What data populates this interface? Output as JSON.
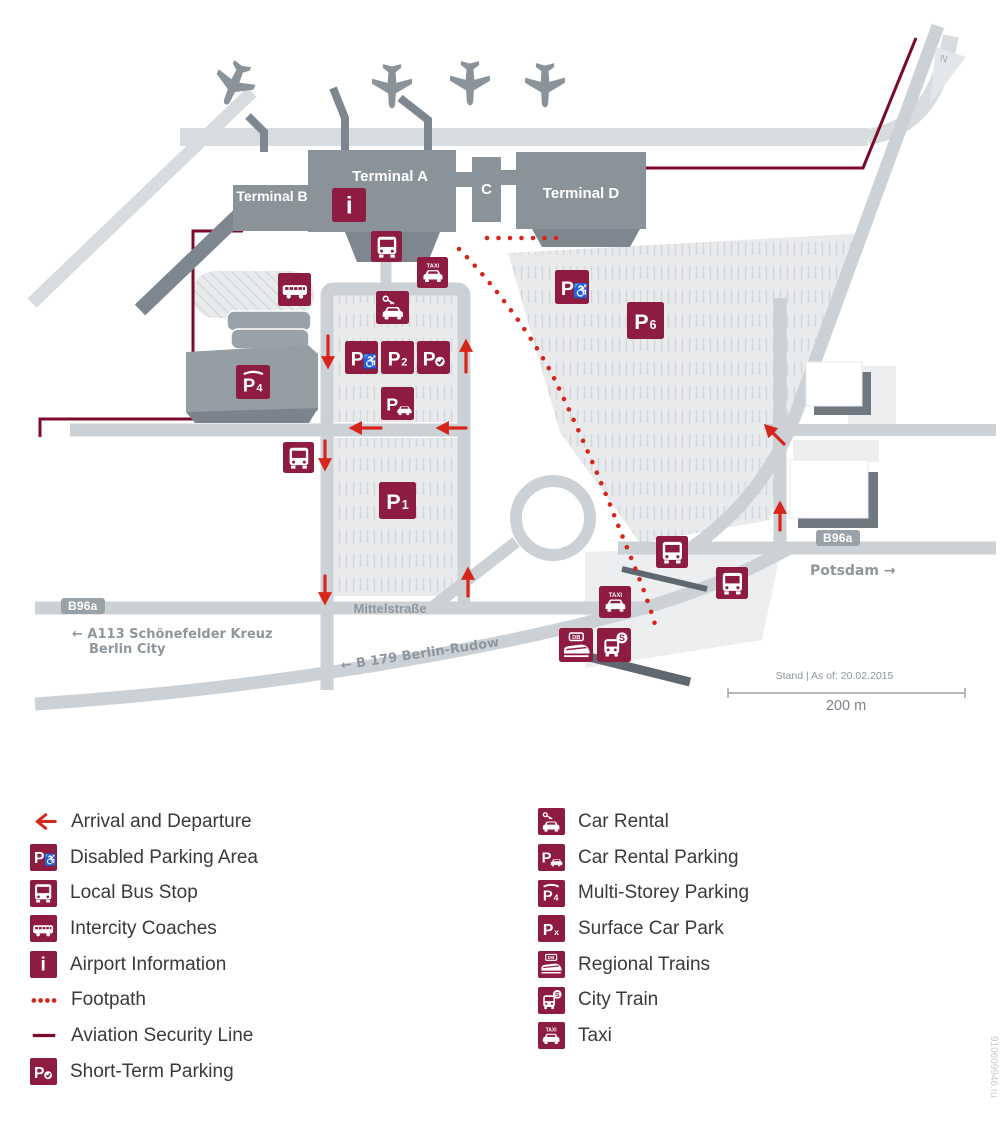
{
  "map": {
    "terminal_a": "Terminal A",
    "terminal_b": "Terminal B",
    "terminal_c": "C",
    "terminal_d": "Terminal D",
    "road_mittelstrasse": "Mittelstraße",
    "badge_b96a": "B96a",
    "dest_a113_line1": "← A113 Schönefelder Kreuz",
    "dest_a113_line2": "Berlin City",
    "dest_b179": "← B 179 Berlin-Rudow",
    "dest_potsdam": "Potsdam →",
    "north": "N",
    "stand": "Stand | As of: 20.02.2015",
    "scale": "200 m"
  },
  "glyphs": {
    "p": "P",
    "one": "1",
    "two": "2",
    "four": "4",
    "six": "6",
    "x": "x",
    "taxi": "TAXI",
    "db": "DB",
    "s": "S",
    "info": "i",
    "wheelchair": "♿"
  },
  "legend": {
    "left": [
      {
        "icon": "arrival-arrow-icon",
        "label": "Arrival and Departure"
      },
      {
        "icon": "disabled-parking-icon",
        "label": "Disabled Parking Area"
      },
      {
        "icon": "local-bus-icon",
        "label": "Local Bus Stop"
      },
      {
        "icon": "intercity-coach-icon",
        "label": "Intercity Coaches"
      },
      {
        "icon": "airport-information-icon",
        "label": "Airport Information"
      },
      {
        "icon": "footpath-dots-icon",
        "label": "Footpath"
      },
      {
        "icon": "aviation-security-line-icon",
        "label": "Aviation Security Line"
      },
      {
        "icon": "short-term-parking-icon",
        "label": "Short-Term Parking"
      }
    ],
    "right": [
      {
        "icon": "car-rental-icon",
        "label": "Car Rental"
      },
      {
        "icon": "car-rental-parking-icon",
        "label": "Car Rental Parking"
      },
      {
        "icon": "multi-storey-parking-icon",
        "label": "Multi-Storey Parking"
      },
      {
        "icon": "surface-car-park-icon",
        "label": "Surface Car Park"
      },
      {
        "icon": "regional-trains-icon",
        "label": "Regional Trains"
      },
      {
        "icon": "city-train-icon",
        "label": "City Train"
      },
      {
        "icon": "taxi-icon",
        "label": "Taxi"
      }
    ]
  },
  "colors": {
    "maroon": "#8e1b40",
    "signal_red": "#d8251b",
    "security_line": "#7c0b2b",
    "terminal_gray": "#8a929a",
    "road_gray": "#ccd1d5"
  },
  "watermark": "910609946.ru"
}
